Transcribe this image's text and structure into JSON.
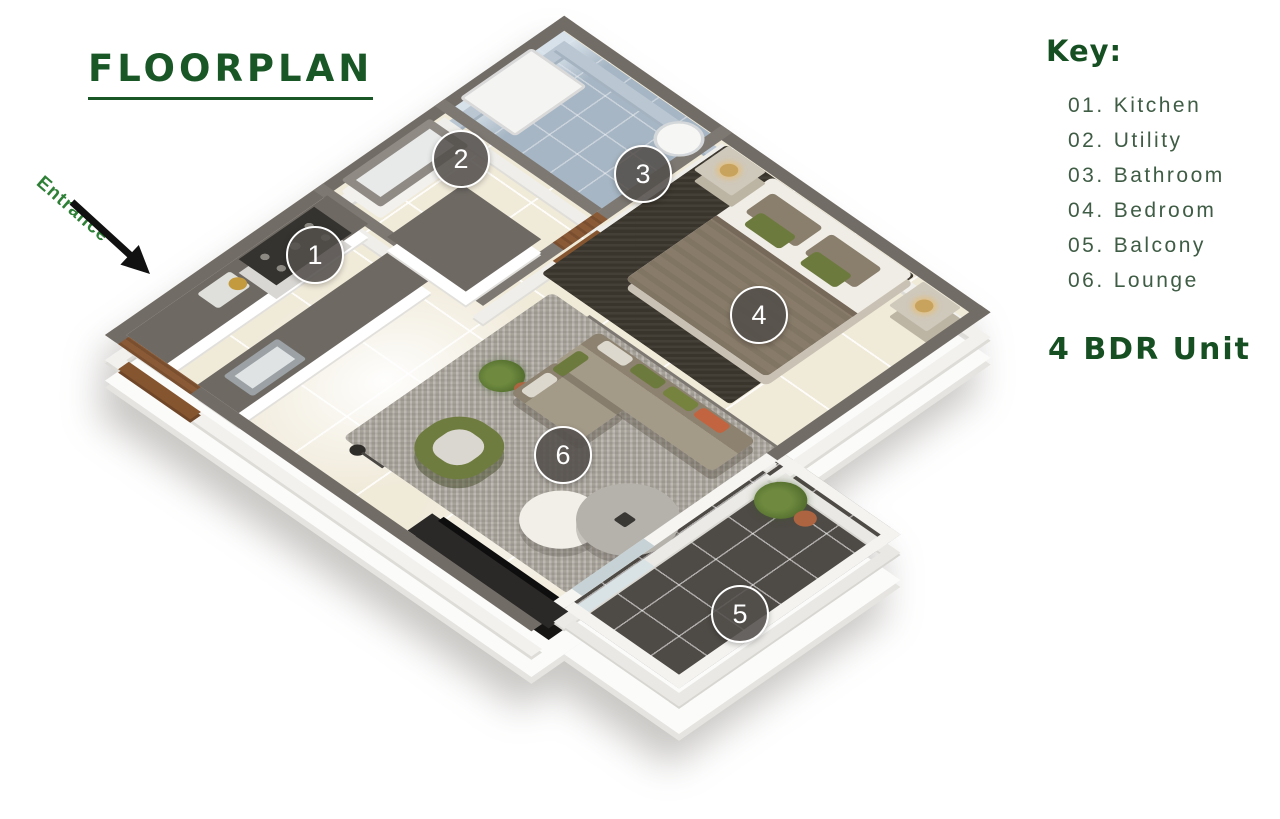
{
  "title": "FLOORPLAN",
  "entrance": {
    "label": "Entrance"
  },
  "key": {
    "heading": "Key:",
    "items": [
      {
        "num": "01.",
        "label": "Kitchen"
      },
      {
        "num": "02.",
        "label": "Utility"
      },
      {
        "num": "03.",
        "label": "Bathroom"
      },
      {
        "num": "04.",
        "label": "Bedroom"
      },
      {
        "num": "05.",
        "label": "Balcony"
      },
      {
        "num": "06.",
        "label": "Lounge"
      }
    ],
    "unit": "4 BDR Unit"
  },
  "markers": [
    {
      "number": "1",
      "room": "Kitchen"
    },
    {
      "number": "2",
      "room": "Utility"
    },
    {
      "number": "3",
      "room": "Bathroom"
    },
    {
      "number": "4",
      "room": "Bedroom"
    },
    {
      "number": "5",
      "room": "Balcony"
    },
    {
      "number": "6",
      "room": "Lounge"
    }
  ],
  "colors": {
    "heading_green": "#1a5727",
    "key_text_green": "#3f5c45",
    "entrance_green": "#2e8036",
    "wall_gray": "#716c66",
    "floor_cream": "#f0ead9",
    "bathroom_blue": "#a7b6c4",
    "balcony_dark": "#4e4a45",
    "badge_gray": "#534f4b",
    "accent_olive": "#6d7a3e",
    "accent_rust": "#c2643f",
    "wood_door": "#8a5a36"
  }
}
